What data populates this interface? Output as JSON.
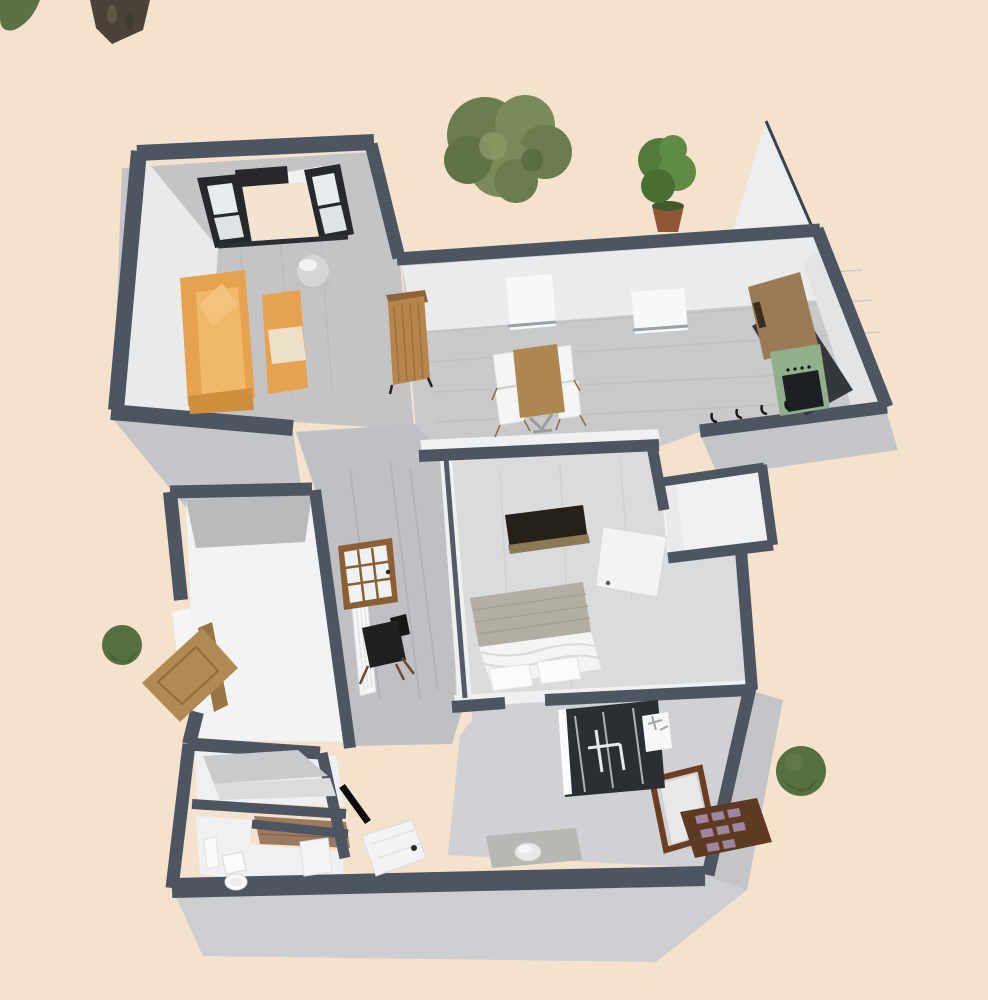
{
  "view": {
    "type": "3d-aerial-floor-plan",
    "description": "Aerial 3D rendering of a furnished apartment floor plan on beige ground, no UI chrome"
  },
  "colors": {
    "ground": "#f4e2cd",
    "wall_top": "#4e5562",
    "wall_dark": "#33383f",
    "wall_exterior": "#c3c5c8",
    "wall_exterior_light": "#cdced1",
    "wall_interior": "#e9ebec",
    "wall_panel_white": "#eceef0",
    "floor_living": "#c4c3c6",
    "floor_dining": "#c9c8cb",
    "floor_hall": "#bec0c3",
    "floor_bedroom": "#dadbdd",
    "floor_bath": "#d0d1d4",
    "floor_closet": "#f2f3f4",
    "floor_storage": "#eff0f1",
    "floor_entry": "#9a7b5f",
    "balcony_floor": "#f2e4d0",
    "frame_black": "#26282c",
    "glass": "#e9ecee",
    "sofa": "#e6a24e",
    "sofa_light": "#f0b869",
    "cushion": "#ece0c8",
    "wood_cabinet": "#b5854d",
    "wood_table": "#ad8750",
    "chair_white": "#f5f5f4",
    "counter_dark": "#34383d",
    "stove_green": "#8fb08a",
    "oven_black": "#1d2023",
    "shelf_wood": "#9b7b55",
    "bed_white": "#f4f4f3",
    "blanket_gray": "#b3aea4",
    "dresser_dark": "#26201a",
    "dresser_base": "#8a7a55",
    "door_white": "#f2f3f4",
    "door_wood": "#b08a52",
    "door_frame_wood": "#9a7544",
    "glazed_frame": "#8a5f33",
    "chair_dark": "#202023",
    "radiator_white": "#f5f6f7",
    "tub_dark": "#2b2f33",
    "porcelain": "#fbfbfb",
    "pallet_wood": "#5e3a22",
    "pallet_cell": "#9e86a0",
    "tree_olive": "#6b7c4f",
    "tree_olive_light": "#7a8a58",
    "tree_green": "#527a3a",
    "bush_green": "#567041",
    "trunk": "#4a4438",
    "pot": "#8f5638",
    "dome": "#d4d5d7"
  },
  "rooms": [
    {
      "name": "living-room",
      "furniture": [
        "orange-sofa",
        "orange-love-seat",
        "silver-dome-lamp"
      ],
      "openings": [
        "french-balcony-doors",
        "black-frame-window"
      ]
    },
    {
      "name": "dining-room",
      "furniture": [
        "wooden-dining-table",
        "white-chair",
        "white-chair",
        "white-chair",
        "white-chair",
        "tall-wooden-cabinet"
      ],
      "openings": [
        "window",
        "window"
      ]
    },
    {
      "name": "kitchen",
      "furniture": [
        "green-stove",
        "dark-counter",
        "wooden-wall-shelf",
        "wall-hooks"
      ]
    },
    {
      "name": "bedroom",
      "furniture": [
        "double-bed",
        "dark-dresser"
      ],
      "openings": [
        "white-door-open"
      ]
    },
    {
      "name": "bedroom-closet",
      "furniture": []
    },
    {
      "name": "hallway",
      "furniture": [
        "white-radiator",
        "leaning-glazed-door",
        "dark-armchair"
      ]
    },
    {
      "name": "entry-closet",
      "openings": [
        "wooden-door-open-outward"
      ]
    },
    {
      "name": "storage",
      "furniture": [
        "gray-shelves"
      ]
    },
    {
      "name": "entry-corridor",
      "furniture": []
    },
    {
      "name": "bathroom-small",
      "furniture": [
        "toilet",
        "white-cabinet"
      ]
    },
    {
      "name": "bathroom-main",
      "furniture": [
        "dark-shower-tub",
        "washbasin"
      ],
      "openings": [
        "wood-framed-exterior-door",
        "white-door-open",
        "black-door-leaf"
      ]
    },
    {
      "name": "laundry-nook",
      "furniture": [
        "white-stool",
        "gray-desk"
      ]
    }
  ],
  "outdoor": {
    "plants": [
      "large-shrub",
      "potted-tree",
      "tree-trunk",
      "corner-foliage",
      "round-bush-west",
      "round-bush-east"
    ],
    "objects": [
      "wooden-pallet-rack"
    ]
  }
}
